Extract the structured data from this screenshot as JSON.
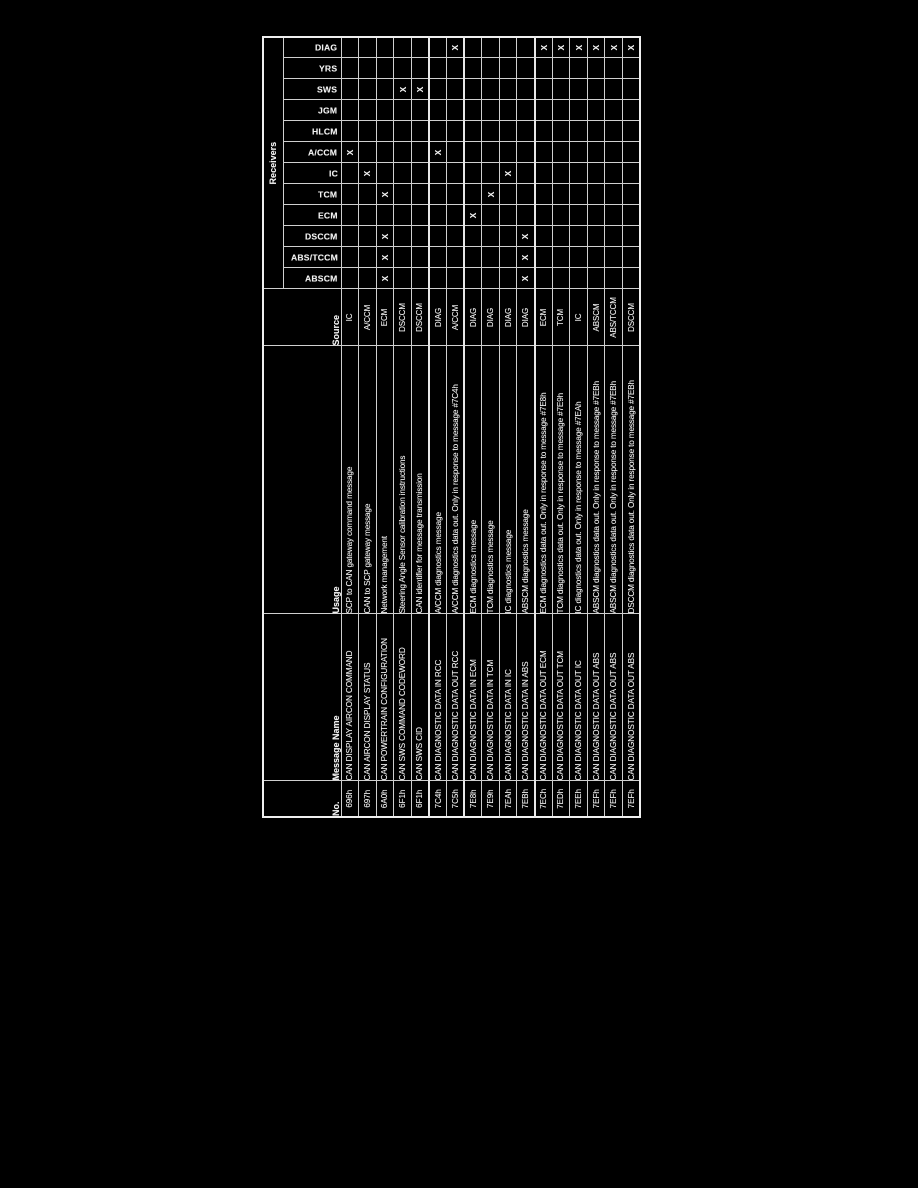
{
  "page": {
    "background_color": "#000000",
    "text_color": "#f2f2f2",
    "grid_color": "#cfcfcf"
  },
  "table": {
    "headers": {
      "no": "No.",
      "message_name": "Message Name",
      "usage": "Usage",
      "source": "Source",
      "receivers": "Receivers"
    },
    "receiver_columns": [
      "ABSCM",
      "ABS/TCCM",
      "DSCCM",
      "ECM",
      "TCM",
      "IC",
      "A/CCM",
      "HLCM",
      "JGM",
      "SWS",
      "YRS",
      "DIAG"
    ],
    "mark": "X",
    "rows": [
      {
        "no": "696h",
        "name": "CAN DISPLAY AIRCON COMMAND",
        "usage": "SCP to CAN gateway command message",
        "source": "IC",
        "receivers": [
          "A/CCM"
        ]
      },
      {
        "no": "697h",
        "name": "CAN AIRCON DISPLAY STATUS",
        "usage": "CAN to SCP gateway message",
        "source": "A/CCM",
        "receivers": [
          "IC"
        ]
      },
      {
        "no": "6A0h",
        "name": "CAN POWERTRAIN CONFIGURATION",
        "usage": "Network management",
        "source": "ECM",
        "receivers": [
          "ABSCM",
          "ABS/TCCM",
          "DSCCM",
          "TCM"
        ]
      },
      {
        "no": "6F1h",
        "name": "CAN SWS COMMAND CODEWORD",
        "usage": "Steering Angle Sensor calibration instructions",
        "source": "DSCCM",
        "receivers": [
          "SWS"
        ]
      },
      {
        "no": "6F1h",
        "name": "CAN SWS CID",
        "usage": "CAN identifier for message transmission",
        "source": "DSCCM",
        "receivers": [
          "SWS"
        ]
      },
      {
        "no": "7C4h",
        "name": "CAN DIAGNOSTIC DATA IN RCC",
        "usage": "A/CCM diagnostics message",
        "source": "DIAG",
        "receivers": [
          "A/CCM"
        ]
      },
      {
        "no": "7C5h",
        "name": "CAN DIAGNOSTIC DATA OUT RCC",
        "usage": "A/CCM diagnostics data out. Only in response to message #7C4h",
        "source": "A/CCM",
        "receivers": [
          "DIAG"
        ]
      },
      {
        "no": "7E8h",
        "name": "CAN DIAGNOSTIC DATA IN ECM",
        "usage": "ECM diagnostics message",
        "source": "DIAG",
        "receivers": [
          "ECM"
        ]
      },
      {
        "no": "7E9h",
        "name": "CAN DIAGNOSTIC DATA IN TCM",
        "usage": "TCM diagnostics message",
        "source": "DIAG",
        "receivers": [
          "TCM"
        ]
      },
      {
        "no": "7EAh",
        "name": "CAN DIAGNOSTIC DATA IN IC",
        "usage": "IC diagnostics message",
        "source": "DIAG",
        "receivers": [
          "IC"
        ]
      },
      {
        "no": "7EBh",
        "name": "CAN DIAGNOSTIC DATA IN ABS",
        "usage": "ABSCM diagnostics message",
        "source": "DIAG",
        "receivers": [
          "ABSCM",
          "ABS/TCCM",
          "DSCCM"
        ]
      },
      {
        "no": "7ECh",
        "name": "CAN DIAGNOSTIC DATA OUT ECM",
        "usage": "ECM diagnostics data out. Only in response to message #7E8h",
        "source": "ECM",
        "receivers": [
          "DIAG"
        ]
      },
      {
        "no": "7EDh",
        "name": "CAN DIAGNOSTIC DATA OUT TCM",
        "usage": "TCM diagnostics data out. Only in response to message #7E9h",
        "source": "TCM",
        "receivers": [
          "DIAG"
        ]
      },
      {
        "no": "7EEh",
        "name": "CAN DIAGNOSTIC DATA OUT IC",
        "usage": "IC diagnostics data out. Only in response to message #7EAh",
        "source": "IC",
        "receivers": [
          "DIAG"
        ]
      },
      {
        "no": "7EFh",
        "name": "CAN DIAGNOSTIC DATA OUT ABS",
        "usage": "ABSCM diagnostics data out. Only in response to message #7EBh",
        "source": "ABSCM",
        "receivers": [
          "DIAG"
        ]
      },
      {
        "no": "7EFh",
        "name": "CAN DIAGNOSTIC DATA OUT ABS",
        "usage": "ABSCM diagnostics data out. Only in response to message #7EBh",
        "source": "ABS/TCCM",
        "receivers": [
          "DIAG"
        ]
      },
      {
        "no": "7EFh",
        "name": "CAN DIAGNOSTIC DATA OUT ABS",
        "usage": "DSCCM diagnostics data out. Only in response to message #7EBh",
        "source": "DSCCM",
        "receivers": [
          "DIAG"
        ]
      }
    ]
  }
}
